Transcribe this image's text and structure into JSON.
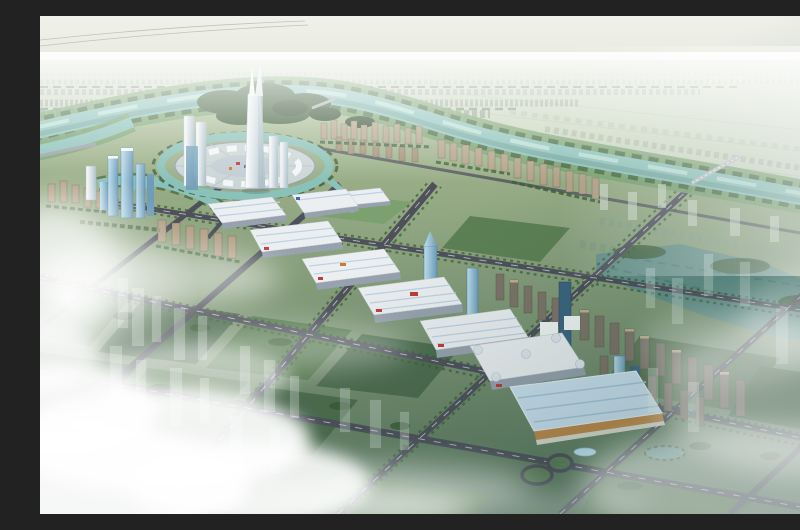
{
  "scene": {
    "type": "aerial-architectural-rendering",
    "description": "Bird's-eye 3D rendering of a planned riverside city district: a winding teal river, a circular central plaza with a forked landmark spire, rows of white exhibition halls with red signage, a tan convention center, glass office towers, tan and brown residential slabs, tree-lined boulevards on a diagonal grid, green blocks with translucent future-phase buildings, a cloverleaf interchange, sunlit clouds at lower left and haze at the horizon",
    "regions": {
      "sky": "hazy pale sky with distant power lines",
      "distant_city": "low-rise city fading into haze beyond the river",
      "river": "winding teal river with forested banks and bridges",
      "central_plaza": "circular landmark plaza ringed by a canal and white canopies",
      "spire": "forked white landmark spire tower",
      "exhibition_halls": "cascading white-roofed trade halls with red and orange signs",
      "convention_center": "large hall with pale blue roof and tan walls beside a cloverleaf interchange",
      "residential": "tan towers along the river, brown slab rows to the southeast",
      "green_blocks": "park blocks with translucent ghost buildings",
      "lake": "dark teal wetland lake on the east side",
      "clouds": "bright clouds and sun glow at lower left, fog at lower right"
    }
  },
  "palette": {
    "sky_top": "#f0f1e9",
    "sky_horizon": "#d8ded0",
    "far_city": "#a9b6a4",
    "fields": "#c6d2b8",
    "corridor": "#74a06c",
    "bank": "#3f6139",
    "river": "#8ac1b8",
    "river_light": "#c2e2d8",
    "river_deep": "#64988f",
    "ground_top": "#a9bc92",
    "ground_bottom": "#55725a",
    "park": "#587a50",
    "field_dark": "#4d6b4e",
    "road": "#4e505a",
    "road_dash": "#d4d7da",
    "tree": "#3a5a36",
    "hall_roof": "#eceff2",
    "hall_shade": "#97a2ae",
    "hall_blue": "#bdd2e2",
    "accent_red": "#c23b35",
    "accent_orange": "#d4762c",
    "conv_wall": "#c08a4a",
    "conv_roof": "#cde2f0",
    "tower_white": "#f3f6f7",
    "tower_white_shade": "#aabfc8",
    "glass_light": "#bfe0ec",
    "glass_mid": "#6f9cba",
    "glass_dark": "#3c6480",
    "tan": "#b3a288",
    "brown": "#7d7468",
    "brown_cap": "#c9b894",
    "ghost": "#e9f3ed",
    "ghost_far": "#dfe9df",
    "lake": "#628f8a",
    "plaza_disc": "#ccd6d6",
    "canopy": "#f4f8f8",
    "cloud": "#ffffff"
  }
}
